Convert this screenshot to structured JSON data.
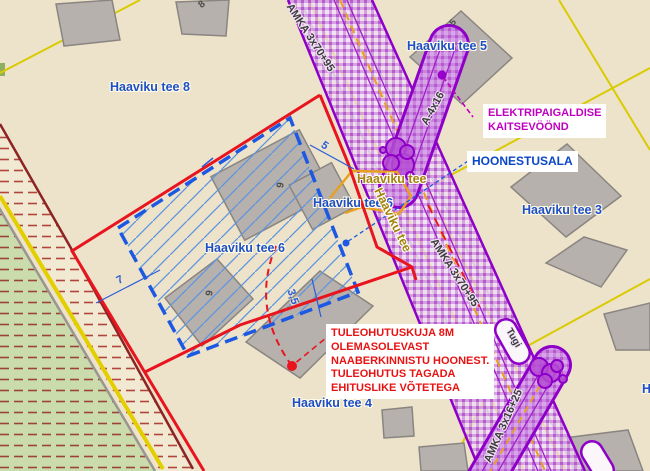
{
  "map_title": "Detail plan view - Haaviku tee",
  "colors": {
    "background": "#EDE3CB",
    "planning_boundary_red": "#E8141E",
    "cadastral_maroon": "#8C2424",
    "cadastral_yellow": "#D9CB00",
    "road_yellow_line": "#E3CE00",
    "corridor_purple": "#8E00C8",
    "hoonestusala_blue": "#1C58E2",
    "parcel_label_blue": "#1D4FC8",
    "street_label_olive": "#A5820A",
    "annotation_magenta": "#C000C0",
    "annotation_red": "#E81212",
    "existing_line_orange": "#E8A020",
    "building_gray": "#B6B1AC",
    "green_area": "#CBDCAC"
  },
  "parcels": {
    "p8": "Haaviku tee 8",
    "p5": "Haaviku tee 5",
    "p3": "Haaviku tee 3",
    "p6": "Haaviku tee 6",
    "p6b": "Haaviku tee 6",
    "p4": "Haaviku tee 4",
    "partial_right_edge": "H"
  },
  "street": {
    "name_horizontal": "Haaviku tee",
    "name_rotated": "Haaviku tee"
  },
  "powerlines": {
    "amka70_upper": "AMKA 3x70+95",
    "amka70_lower": "AMKA 3x70+95",
    "a4x16": "A-4x16",
    "amka16": "AMKA 3x16+25",
    "tugi": "Tugi"
  },
  "annotations": {
    "elektri_line1": "ELEKTRIPAIGALDISE",
    "elektri_line2": "KAITSEVÖÖND",
    "hoonestusala": "HOONESTUSALA",
    "fire_line1": "TULEOHUTUSKUJA 8M",
    "fire_line2": "OLEMASOLEVAST",
    "fire_line3": "NAABERKINNISTU HOONEST.",
    "fire_line4": "TULEOHUTUS TAGADA",
    "fire_line5": "EHITUSLIKE VÕTETEGA"
  },
  "dimensions": {
    "d5": "5",
    "d7": "7",
    "d35": "3,5"
  },
  "building_numbers": {
    "b8": "8",
    "b6_main": "6",
    "b6_small": "6",
    "b5_tiny": "5"
  }
}
